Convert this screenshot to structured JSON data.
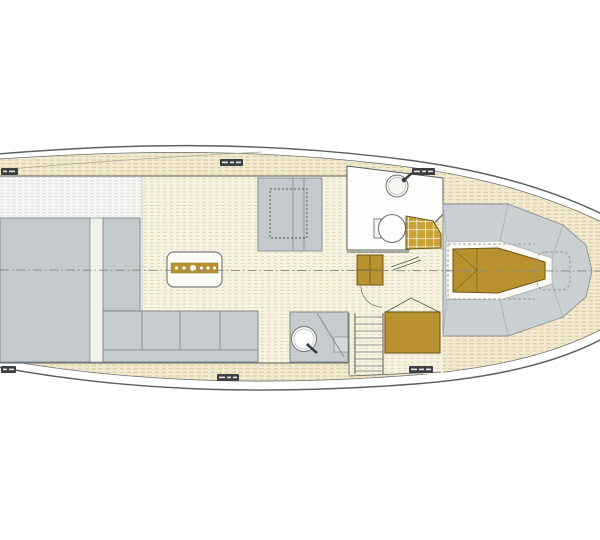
{
  "document": {
    "kind": "yacht interior deck plan, top view",
    "orientation": "bow to the right"
  },
  "colors": {
    "paper": "#ffffff",
    "teak_deck": "#f2ead0",
    "teak_seam": "#d5c494",
    "cabin_floor": "#f7f3e2",
    "cool_floor": "#f5f7f5",
    "furniture_gray": "#c3c9cc",
    "foredeck_gray": "#cacfd2",
    "joinery_gold": "#b9922f",
    "outline": "#5a5f63",
    "badge": "#3c3f41",
    "centerline": "#85857d"
  },
  "dimension_badges": {
    "count": 6,
    "text_legible": false
  },
  "fixtures": [
    {
      "label": "hull outline"
    },
    {
      "label": "teak side decks"
    },
    {
      "label": "saloon floor"
    },
    {
      "label": "aft cabin berth"
    },
    {
      "label": "dinette sofa with dashed table"
    },
    {
      "label": "saloon table with gold counter and place dots"
    },
    {
      "label": "galley counters"
    },
    {
      "label": "galley sink module"
    },
    {
      "label": "head compartment"
    },
    {
      "label": "washbasin with tap"
    },
    {
      "label": "toilet"
    },
    {
      "label": "gold shower pan grid"
    },
    {
      "label": "companionway steps"
    },
    {
      "label": "ladder with treads"
    },
    {
      "label": "gold cabinet"
    },
    {
      "label": "gold V-berth with cross bracing"
    },
    {
      "label": "foredeck with seam lines"
    },
    {
      "label": "dashed windlass / hatch outline"
    },
    {
      "label": "dash-dot centerline"
    },
    {
      "label": "wall-mounted panel"
    }
  ]
}
